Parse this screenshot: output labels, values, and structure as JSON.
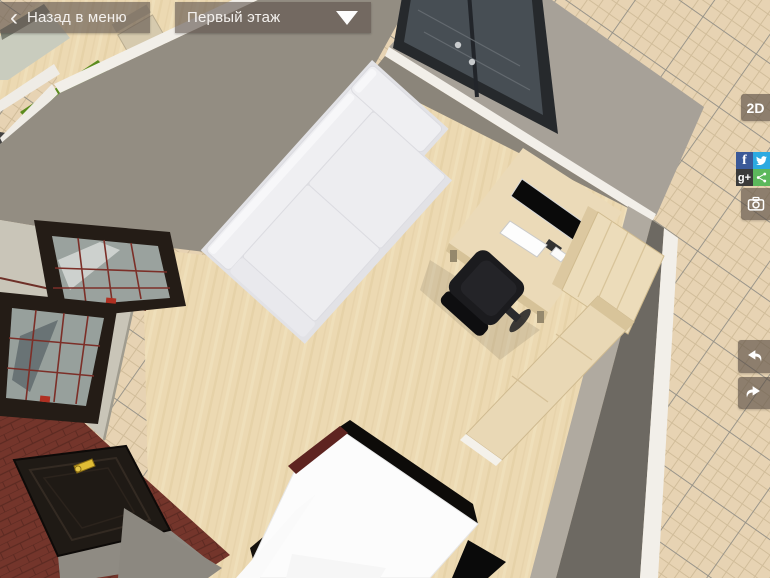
{
  "top_bar": {
    "back_button": {
      "icon": "‹",
      "label": "Назад в меню"
    },
    "floor_selector": {
      "value": "Первый этаж"
    }
  },
  "toolbar": {
    "view_2d_label": "2D",
    "facebook_glyph": "f",
    "google_plus_glyph": "g+",
    "colors": {
      "button_bg": "rgba(86,75,66,0.62)",
      "facebook": "#3b5998",
      "twitter": "#2caae1",
      "google_plus": "#3a3a3a",
      "share": "#5cb85c"
    }
  },
  "scene": {
    "objects": [
      "grid-floor",
      "kitchen-floor",
      "kitchen-cabinets",
      "kitchen-counter",
      "green-rug",
      "wooden-chair",
      "wall-northwest",
      "wall-windows",
      "window-upper",
      "window-lower",
      "french-doors",
      "wall-right",
      "brick-floor",
      "entry-door",
      "living-room-floor",
      "corner-sofa",
      "computer-desk",
      "monitor",
      "keyboard",
      "mouse",
      "office-chair",
      "wardrobe",
      "sideboard",
      "dining-table",
      "tv-black-panel"
    ],
    "palette": {
      "grid_bg": "#e7d3b3",
      "grid_line": "#d1bd9a",
      "grid_major": "#8e8c84",
      "wall": "#938d82",
      "wall_light": "#c9c5b8",
      "wall_top": "#f2efe9",
      "wall_dark": "#6d6962",
      "wood_floor": "#ecd9b2",
      "sofa": "#efeff2",
      "desk_wood": "#ebdab8",
      "brick": "#74352b",
      "rug_green": "#5c8c1e",
      "window_frame": "#241c16",
      "door": "#1f1a15",
      "door_handle": "#e0bc35",
      "monitor": "#0a0a0a",
      "chair_black": "#1b1b1e",
      "glass": "#474e54"
    }
  }
}
